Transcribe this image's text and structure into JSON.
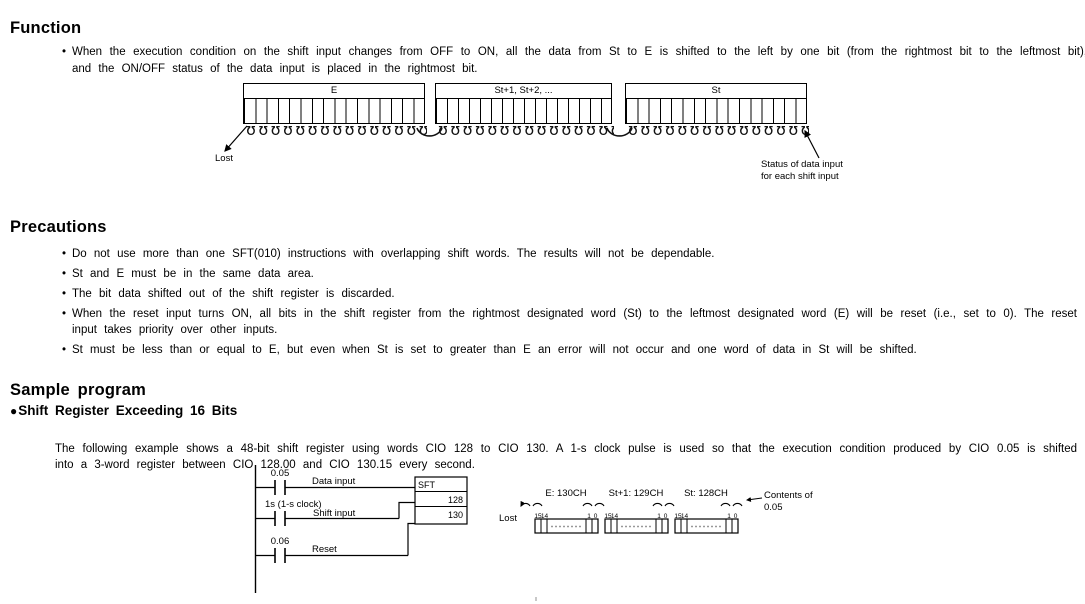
{
  "icons": {
    "bullet": "•",
    "section_bullet": "●",
    "shift_loop": "ʊ"
  },
  "function": {
    "heading": "Function",
    "bullet_text": "When the execution condition on the shift input changes from OFF to ON, all the data from St to E is shifted to the left by one bit (from the rightmost bit to the leftmost bit), and the ON/OFF status of the data input is placed in the rightmost bit."
  },
  "shift_diagram": {
    "box_e": "E",
    "box_mid": "St+1, St+2, ...",
    "box_st": "St",
    "lost": "Lost",
    "status_line1": "Status of data input",
    "status_line2": "for each shift input"
  },
  "precautions": {
    "heading": "Precautions",
    "bullets": [
      "Do not use more than one SFT(010) instructions with overlapping shift words. The results will not be dependable.",
      "St and E must be in the same data area.",
      "The bit data shifted out of the shift register is discarded.",
      "When the reset input turns ON, all bits in the shift register from the rightmost designated word (St) to the leftmost designated word (E) will be reset (i.e., set to 0). The reset input takes priority over other inputs.",
      "St must be less than or equal to E, but even when St is set to greater than E an error will not occur and one word of data in St will be shifted."
    ]
  },
  "sample": {
    "heading": "Sample program",
    "subheading": "Shift Register Exceeding 16 Bits",
    "description": "The following example shows a 48-bit shift register using words CIO 128 to CIO 130. A 1-s clock pulse is used so that the execution condition produced by CIO 0.05 is shifted into a 3-word register between CIO 128.00 and CIO 130.15 every second.",
    "ladder": {
      "rung1_address": "0.05",
      "rung1_label": "Data input",
      "rung2_address": "1s (1-s clock)",
      "rung2_label": "Shift input",
      "rung3_address": "0.06",
      "rung3_label": "Reset",
      "instruction": "SFT",
      "operand_st": "128",
      "operand_e": "130"
    },
    "registers": {
      "lost": "Lost",
      "word_e": "E: 130CH",
      "word_st1": "St+1: 129CH",
      "word_st": "St: 128CH",
      "bit15": "15",
      "bit14": "14",
      "bit1": "1",
      "bit0": "0",
      "contents_line1": "Contents of",
      "contents_line2": "0.05"
    }
  }
}
